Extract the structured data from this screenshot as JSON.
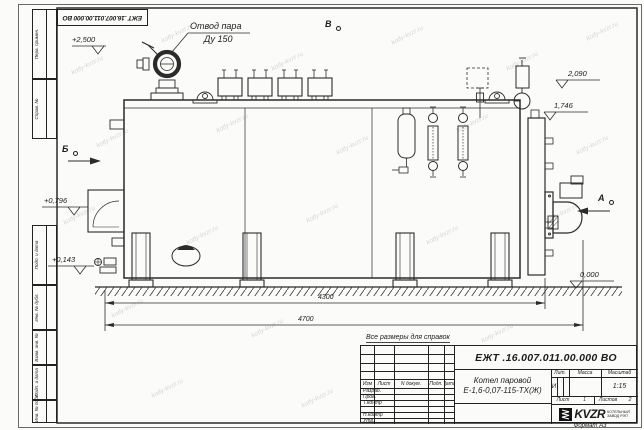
{
  "sheet": {
    "format_note": "Формат А3"
  },
  "corner_stamp": {
    "designation": "ЕЖТ .16.007.011.00.000  ВО"
  },
  "margin_labels": {
    "top": [
      "Перв. примен.",
      "Справ. №"
    ],
    "bottom": [
      "Подп. и дата",
      "Инв. № дубл.",
      "Взам. инв. №",
      "Подп. и дата",
      "Инв. № подл."
    ]
  },
  "watermark": {
    "text": "kotly-kvzr.ru"
  },
  "drawing": {
    "note": "Все размеры для справок",
    "steam_callout": {
      "line1": "Отвод пара",
      "line2": "Ду 150"
    },
    "view_b": "В",
    "view_bb": "Б",
    "view_a": "А",
    "elev_2500": "+2,500",
    "elev_2090": "2,090",
    "elev_1746": "1,746",
    "elev_0796": "+0,796",
    "elev_0143": "+0,143",
    "elev_0000": "0,000",
    "dim_4300": "4300",
    "dim_4700": "4700"
  },
  "title_block": {
    "designation": "ЕЖТ .16.007.011.00.000  ВО",
    "doc_name_line1": "Котел паровой",
    "doc_name_line2": "Е-1,6-0,07-115-ТХ(Ж)",
    "cols": {
      "izm": "Изм",
      "list": "Лист",
      "ndoc": "N докум.",
      "podp": "Подп.",
      "data": "Дата"
    },
    "rows": {
      "razrab": "Разраб.",
      "prov": "Пров.",
      "tkontr": "Т.контр",
      "nkontr": "Н.контр",
      "utv": "Утв."
    },
    "lit": {
      "header": "Лит.",
      "value": "И"
    },
    "massa": {
      "header": "Масса"
    },
    "scale": {
      "header": "Масштаб",
      "value": "1:15"
    },
    "sheet": {
      "label": "Лист",
      "value": "1"
    },
    "sheets": {
      "label": "Листов",
      "value": "2"
    },
    "company": {
      "name": "KVZR",
      "sub1": "КОТЕЛЬНЫЙ",
      "sub2": "ЗАВОД РЭП"
    }
  }
}
